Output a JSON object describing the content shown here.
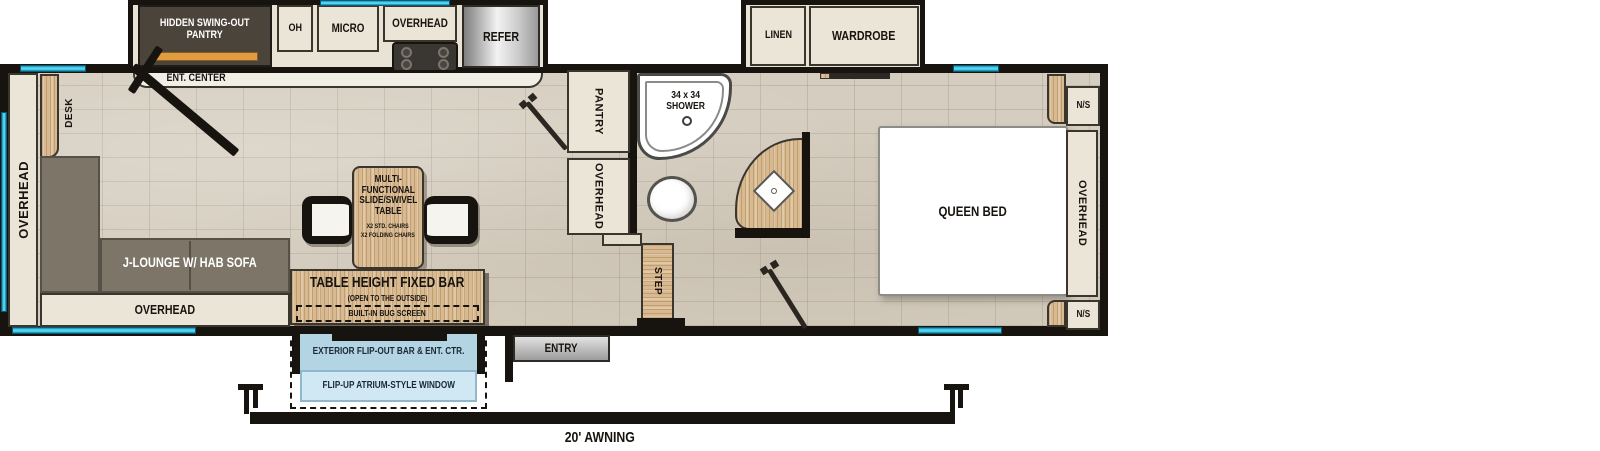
{
  "plan": {
    "kitchen": {
      "hidden_pantry": "HIDDEN SWING-OUT\nPANTRY",
      "oh": "OH",
      "micro": "MICRO",
      "overhead": "OVERHEAD",
      "refer": "REFER",
      "ent_center": "ENT. CENTER"
    },
    "living": {
      "desk": "DESK",
      "overhead_wall": "OVERHEAD",
      "sofa": "J-LOUNGE W/ HAB SOFA",
      "overhead_lower": "OVERHEAD"
    },
    "dinette": {
      "table": "MULTI-\nFUNCTIONAL\nSLIDE/SWIVEL\nTABLE",
      "chairs_std": "X2 STD. CHAIRS",
      "chairs_folding": "X2 FOLDING CHAIRS",
      "bar": "TABLE HEIGHT FIXED BAR",
      "bar_note": "(OPEN TO THE OUTSIDE)",
      "bug_screen": "BUILT-IN BUG SCREEN",
      "exterior_bar": "EXTERIOR FLIP-OUT BAR & ENT. CTR.",
      "atrium_window": "FLIP-UP ATRIUM-STYLE WINDOW"
    },
    "bath": {
      "pantry": "PANTRY",
      "overhead": "OVERHEAD",
      "shower": "34 x 34\nSHOWER",
      "step": "STEP",
      "entry": "ENTRY"
    },
    "bedroom": {
      "linen": "LINEN",
      "wardrobe": "WARDROBE",
      "bed": "QUEEN BED",
      "ns_top": "N/S",
      "ns_bottom": "N/S",
      "overhead": "OVERHEAD"
    },
    "awning": "20' AWNING",
    "colors": {
      "wall": "#17130f",
      "window_cyan": "#52d4ef",
      "wood": "#d9ba90",
      "cabinet": "#eae5d7",
      "sofa_gray": "#7d7568",
      "floor_tile": "#d5cdbf",
      "pantry_orange": "#df9c40",
      "exterior_bar_blue": "#b3d4e2",
      "atrium_blue": "#cfe8f4"
    }
  }
}
